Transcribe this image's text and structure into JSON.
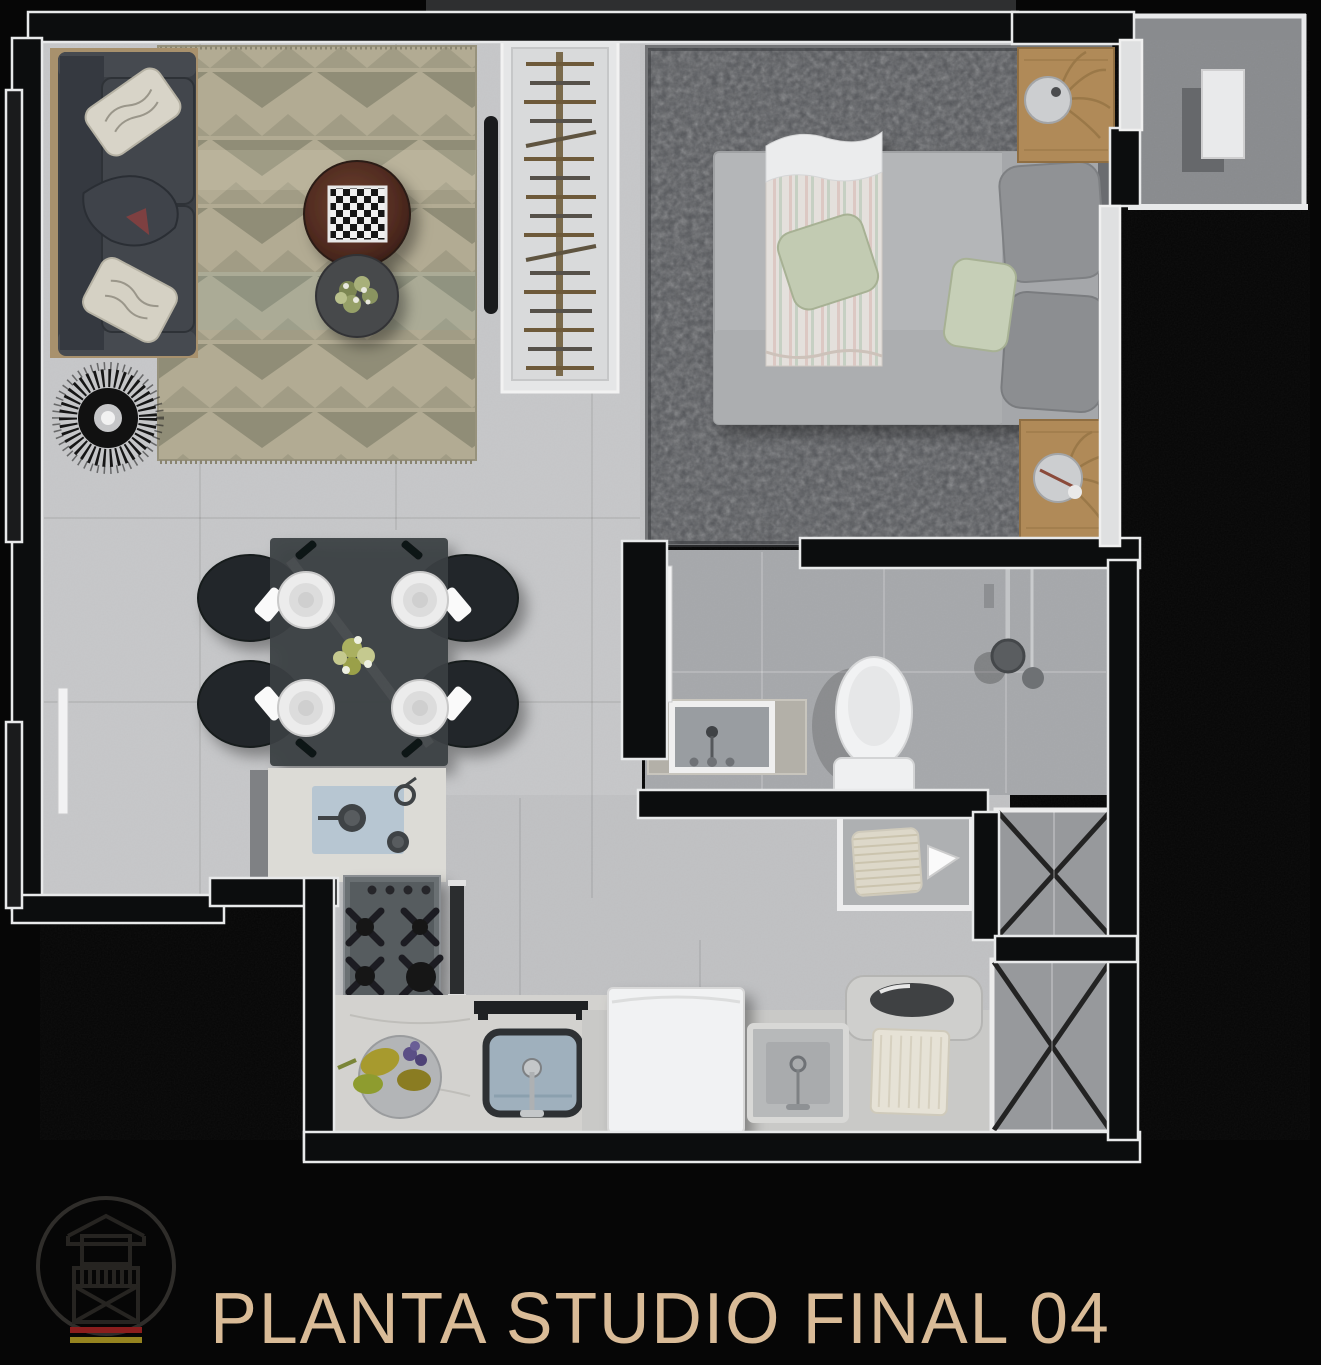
{
  "title": {
    "text": "PLANTA STUDIO FINAL 04"
  },
  "logo": {
    "icon": "house-balcony-logo-icon",
    "shape": "circle-outline",
    "stripe_colors": [
      "#8a1d1d",
      "#95831f"
    ]
  },
  "colors": {
    "background": "#060606",
    "wall": "#0c0d0e",
    "wall_trim": "#e8e9ea",
    "floor_main": "#c6c7c9",
    "floor_bathroom": "#a6a8ab",
    "floor_balcony": "#898b8e",
    "bedroom_rug": "#54565a",
    "living_rug_base": "#b2ab93",
    "living_rug_triangle": "#908d77",
    "wood": "#b08a58",
    "title_text": "#d9bb97"
  },
  "plan": {
    "rooms": [
      {
        "name": "living-room",
        "furniture": [
          "sofa",
          "decor-pillows",
          "chevron-area-rug",
          "round-coffee-table",
          "chess-board",
          "side-table-with-plant",
          "wire-fan-chair",
          "tv-panel"
        ]
      },
      {
        "name": "closet",
        "furniture": [
          "clothes-rail",
          "hangers"
        ]
      },
      {
        "name": "bedroom",
        "furniture": [
          "double-bed",
          "striped-throw",
          "green-pillows",
          "gray-pillows",
          "shag-rug",
          "nightstand-with-lamp-top",
          "nightstand-with-lamp-bottom"
        ]
      },
      {
        "name": "balcony",
        "furniture": [
          "condenser-unit"
        ]
      },
      {
        "name": "dining-area",
        "furniture": [
          "glass-dining-table",
          "black-chair-x4",
          "place-setting-x4",
          "flower-centerpiece"
        ]
      },
      {
        "name": "kitchen",
        "furniture": [
          "marble-counter",
          "cutting-board-with-pans",
          "gas-cooktop",
          "oven-panel",
          "kitchen-sink",
          "fruit-bowl",
          "towel-bar"
        ]
      },
      {
        "name": "bathroom",
        "furniture": [
          "vanity-sink",
          "toilet",
          "shower-set",
          "door-leaf"
        ]
      },
      {
        "name": "laundry",
        "furniture": [
          "washing-machine",
          "laundry-sink",
          "folded-towel",
          "wash-tub",
          "towel-niche"
        ]
      },
      {
        "name": "shafts",
        "furniture": [
          "duct-x-upper",
          "duct-x-lower"
        ]
      }
    ]
  }
}
